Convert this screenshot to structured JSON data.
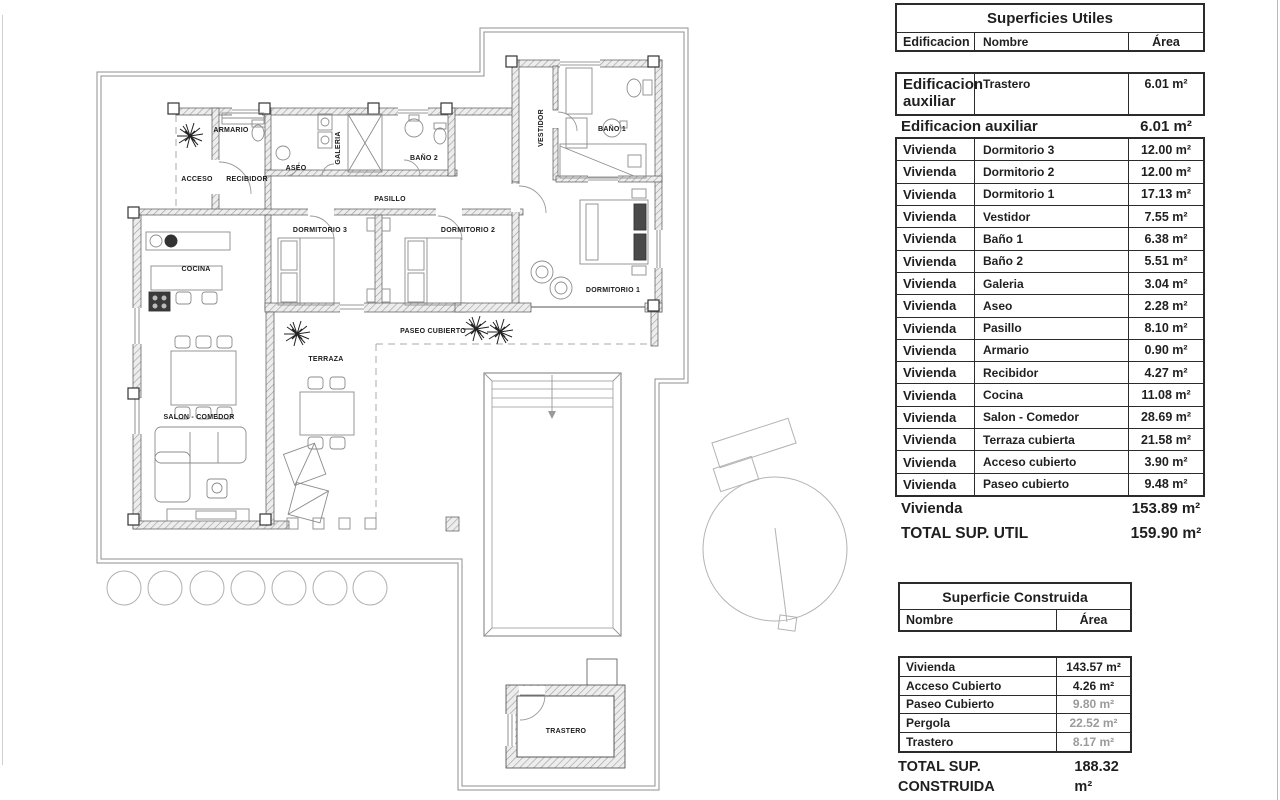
{
  "plan": {
    "labels": {
      "armario": "ARMARIO",
      "acceso": "ACCESO",
      "recibidor": "RECIBIDOR",
      "aseo": "ASEO",
      "galeria": "GALERIA",
      "bano2": "BAÑO 2",
      "pasillo": "PASILLO",
      "vestidor": "VESTIDOR",
      "bano1": "BAÑO 1",
      "dormitorio3": "DORMITORIO 3",
      "dormitorio2": "DORMITORIO 2",
      "dormitorio1": "DORMITORIO 1",
      "cocina": "COCINA",
      "paseo_cubierto": "PASEO CUBIERTO",
      "terraza": "TERRAZA",
      "salon_comedor": "SALON - COMEDOR",
      "trastero": "TRASTERO"
    }
  },
  "tables": {
    "utiles": {
      "title": "Superficies Utiles",
      "columns": [
        "Edificacion",
        "Nombre",
        "Área"
      ],
      "aux_row": {
        "edificacion": "Edificacion auxiliar",
        "nombre": "Trastero",
        "area": "6.01 m²"
      },
      "aux_total": {
        "label": "Edificacion auxiliar",
        "area": "6.01 m²"
      },
      "vivienda_rows": [
        {
          "edificacion": "Vivienda",
          "nombre": "Dormitorio 3",
          "area": "12.00 m²"
        },
        {
          "edificacion": "Vivienda",
          "nombre": "Dormitorio 2",
          "area": "12.00 m²"
        },
        {
          "edificacion": "Vivienda",
          "nombre": "Dormitorio 1",
          "area": "17.13 m²"
        },
        {
          "edificacion": "Vivienda",
          "nombre": "Vestidor",
          "area": "7.55 m²"
        },
        {
          "edificacion": "Vivienda",
          "nombre": "Baño 1",
          "area": "6.38 m²"
        },
        {
          "edificacion": "Vivienda",
          "nombre": "Baño 2",
          "area": "5.51 m²"
        },
        {
          "edificacion": "Vivienda",
          "nombre": "Galeria",
          "area": "3.04 m²"
        },
        {
          "edificacion": "Vivienda",
          "nombre": "Aseo",
          "area": "2.28 m²"
        },
        {
          "edificacion": "Vivienda",
          "nombre": "Pasillo",
          "area": "8.10 m²"
        },
        {
          "edificacion": "Vivienda",
          "nombre": "Armario",
          "area": "0.90 m²"
        },
        {
          "edificacion": "Vivienda",
          "nombre": "Recibidor",
          "area": "4.27 m²"
        },
        {
          "edificacion": "Vivienda",
          "nombre": "Cocina",
          "area": "11.08 m²"
        },
        {
          "edificacion": "Vivienda",
          "nombre": "Salon - Comedor",
          "area": "28.69 m²"
        },
        {
          "edificacion": "Vivienda",
          "nombre": "Terraza cubierta",
          "area": "21.58 m²"
        },
        {
          "edificacion": "Vivienda",
          "nombre": "Acceso cubierto",
          "area": "3.90 m²"
        },
        {
          "edificacion": "Vivienda",
          "nombre": "Paseo cubierto",
          "area": "9.48 m²"
        }
      ],
      "vivienda_total": {
        "label": "Vivienda",
        "area": "153.89 m²"
      },
      "total": {
        "label": "TOTAL SUP. UTIL",
        "area": "159.90 m²"
      }
    },
    "construida": {
      "title": "Superficie Construida",
      "columns": [
        "Nombre",
        "Área"
      ],
      "rows": [
        {
          "nombre": "Vivienda",
          "area": "143.57 m²",
          "faded": false
        },
        {
          "nombre": "Acceso Cubierto",
          "area": "4.26 m²",
          "faded": false
        },
        {
          "nombre": "Paseo Cubierto",
          "area": "9.80 m²",
          "faded": true
        },
        {
          "nombre": "Pergola",
          "area": "22.52 m²",
          "faded": true
        },
        {
          "nombre": "Trastero",
          "area": "8.17 m²",
          "faded": true
        }
      ],
      "total": {
        "label": "TOTAL SUP. CONSTRUIDA",
        "area": "188.32 m²"
      }
    }
  }
}
